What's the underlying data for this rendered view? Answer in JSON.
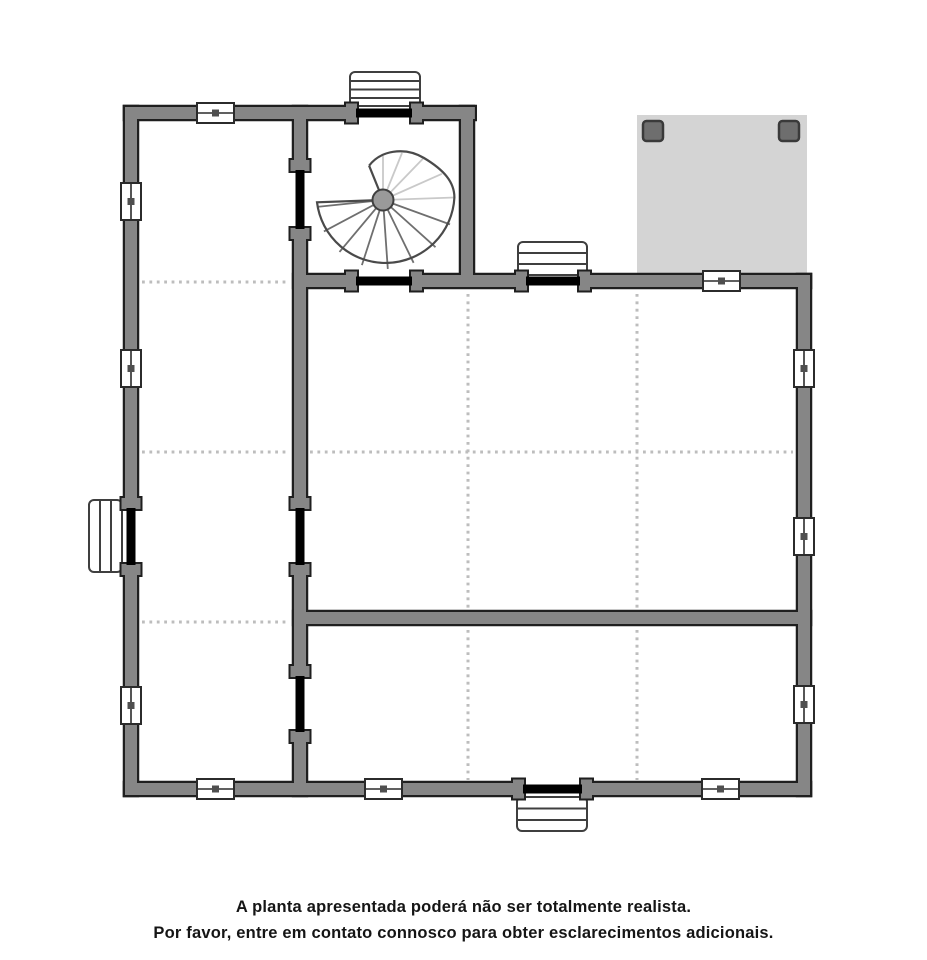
{
  "caption": {
    "line1": "A planta apresentada poderá não ser totalmente realista.",
    "line2": "Por favor, entre em contato connosco para obter esclarecimentos adicionais."
  },
  "colors": {
    "background": "#ffffff",
    "wall_fill": "#868686",
    "wall_outline": "#1f1f1f",
    "door_gap": "#000000",
    "terrace_fill": "#d4d4d4",
    "pillar_fill": "#6e6e6e",
    "pillar_outline": "#3a3a3a",
    "window_fill": "#ffffff",
    "window_outline": "#2b2b2b",
    "window_dot": "#4f4f4f",
    "steps_fill": "#ffffff",
    "steps_outline": "#3f3f3f",
    "dotted_line": "#bdbdbd",
    "stair_outline": "#4a4a4a",
    "stair_spoke_light": "#c9c9c9",
    "stair_spoke_dark": "#6f6f6f",
    "stair_hub_fill": "#9a9a9a",
    "caption_text": "#151515"
  },
  "plan": {
    "type": "floor-plan",
    "features": [
      "spiral-staircase",
      "terrace-with-two-pillars",
      "exterior-steps-top",
      "exterior-steps-upper-middle",
      "exterior-steps-left",
      "exterior-steps-bottom"
    ],
    "window_count": 11,
    "door_opening_count": 8,
    "room_count": 4
  }
}
